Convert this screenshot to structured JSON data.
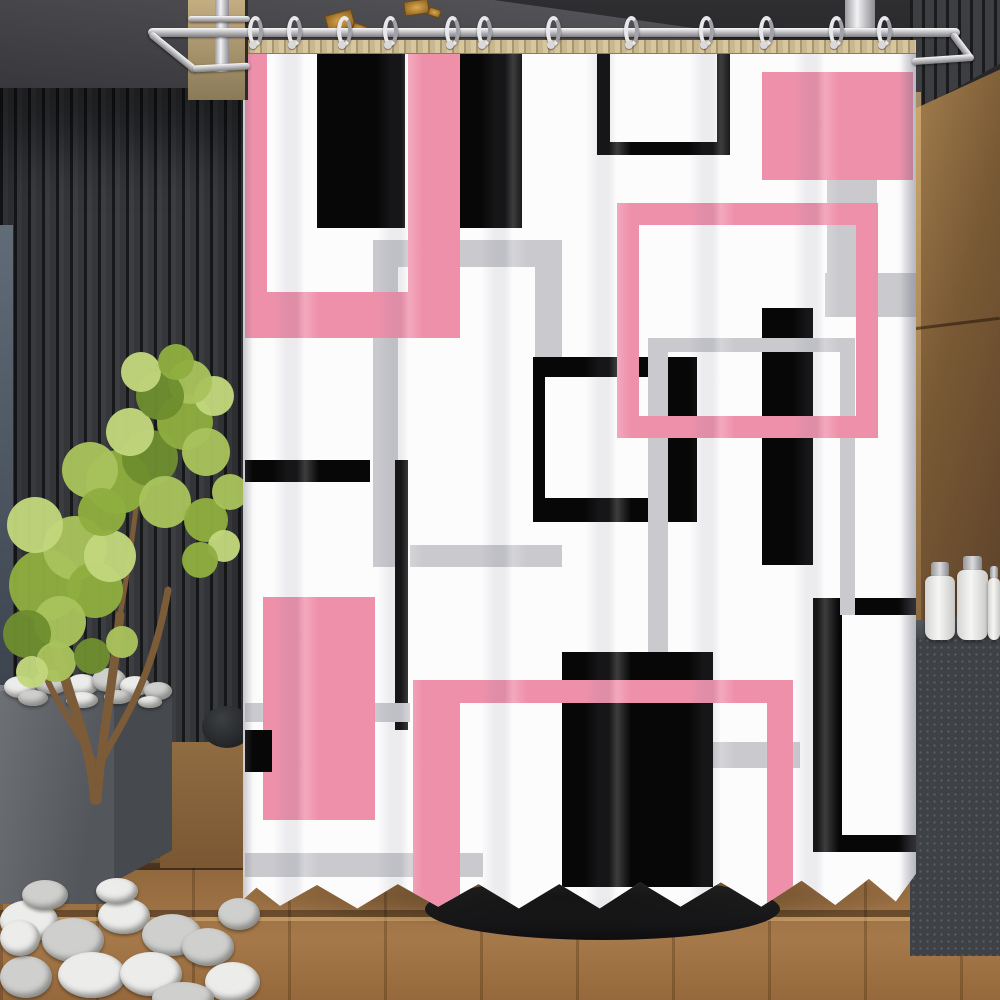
{
  "meta": {
    "description": "Product photo: white shower curtain with abstract pink, black and gray geometric rectangles, hanging from a chrome rod with C-rings in a modern bathroom with dark slatted walls, green potted tree, white pebbles, wooden plank floor, bronze wood wall and dark vanity with white bottles"
  },
  "palette": {
    "pink": "#EF90AB",
    "black": "#070707",
    "gray": "#C9C9CE",
    "curtain_white": "#FCFCFD",
    "pebble_light": "#ECECEA",
    "pebble_dark": "#CFCFCD",
    "greens": [
      "#8FAE3F",
      "#A9C35C",
      "#C2D67C",
      "#6E8E2F"
    ],
    "trunk": "#7B5B38",
    "gold": "#C9913B",
    "chrome": "#F0F0F2",
    "wood_floor": "#9A7142",
    "wood_wall": "#7A5A35",
    "tub": "#18181A"
  },
  "curtain": {
    "x": 243,
    "y": 40,
    "w": 673,
    "h": 872,
    "pattern": [
      {
        "name": "gray-open-frame-top",
        "color": "gray",
        "x": 130,
        "y": 200,
        "w": 189,
        "h": 27
      },
      {
        "name": "gray-open-frame-left-leg",
        "color": "gray",
        "x": 130,
        "y": 200,
        "w": 25,
        "h": 327
      },
      {
        "name": "gray-open-frame-right-leg",
        "color": "gray",
        "x": 292,
        "y": 200,
        "w": 27,
        "h": 125
      },
      {
        "name": "pink-u-left-arm",
        "color": "pink",
        "x": 2,
        "y": 10,
        "w": 22,
        "h": 288
      },
      {
        "name": "pink-u-bottom-bar",
        "color": "pink",
        "x": 2,
        "y": 252,
        "w": 215,
        "h": 46
      },
      {
        "name": "pink-u-right-arm",
        "color": "pink",
        "x": 165,
        "y": 10,
        "w": 52,
        "h": 252
      },
      {
        "name": "black-rect-top-1",
        "color": "black",
        "x": 74,
        "y": 10,
        "w": 88,
        "h": 178
      },
      {
        "name": "black-rect-top-2",
        "color": "black",
        "x": 217,
        "y": 10,
        "w": 62,
        "h": 178
      },
      {
        "name": "black-open-frame-left-edge",
        "color": "black",
        "x": 354,
        "y": 10,
        "w": 13,
        "h": 105
      },
      {
        "name": "black-open-frame-right-edge",
        "color": "black",
        "x": 474,
        "y": 10,
        "w": 13,
        "h": 105
      },
      {
        "name": "black-open-frame-bottom-edge",
        "color": "black",
        "x": 354,
        "y": 102,
        "w": 133,
        "h": 13
      },
      {
        "name": "pink-solid-rect-top-right",
        "color": "pink",
        "x": 519,
        "y": 32,
        "w": 151,
        "h": 108
      },
      {
        "name": "gray-bar-vertical-right",
        "color": "gray",
        "x": 584,
        "y": 140,
        "w": 50,
        "h": 100
      },
      {
        "name": "gray-bar-horizontal-right",
        "color": "gray",
        "x": 582,
        "y": 233,
        "w": 91,
        "h": 44
      },
      {
        "name": "black-frame-mid-left-edge",
        "color": "black",
        "x": 290,
        "y": 317,
        "w": 12,
        "h": 165
      },
      {
        "name": "black-frame-mid-top-edge",
        "color": "black",
        "x": 290,
        "y": 317,
        "w": 164,
        "h": 20
      },
      {
        "name": "black-frame-mid-bottom-edge",
        "color": "black",
        "x": 290,
        "y": 458,
        "w": 164,
        "h": 24
      },
      {
        "name": "black-frame-mid-right-bar",
        "color": "black",
        "x": 420,
        "y": 317,
        "w": 34,
        "h": 165
      },
      {
        "name": "black-bar-tall-right",
        "color": "black",
        "x": 519,
        "y": 268,
        "w": 51,
        "h": 257
      },
      {
        "name": "black-rect-large-bottom",
        "color": "black",
        "x": 319,
        "y": 612,
        "w": 151,
        "h": 235
      },
      {
        "name": "black-frame-br-top-edge",
        "color": "black",
        "x": 570,
        "y": 558,
        "w": 103,
        "h": 17
      },
      {
        "name": "black-frame-br-left-edge",
        "color": "black",
        "x": 570,
        "y": 558,
        "w": 29,
        "h": 254
      },
      {
        "name": "black-frame-br-bottom-edge",
        "color": "black",
        "x": 570,
        "y": 795,
        "w": 103,
        "h": 17
      },
      {
        "name": "gray-frame-2-top-edge",
        "color": "gray",
        "x": 405,
        "y": 298,
        "w": 205,
        "h": 14
      },
      {
        "name": "gray-frame-2-left-leg",
        "color": "gray",
        "x": 405,
        "y": 298,
        "w": 20,
        "h": 314
      },
      {
        "name": "gray-frame-2-right-leg",
        "color": "gray",
        "x": 597,
        "y": 298,
        "w": 15,
        "h": 277
      },
      {
        "name": "pink-frame-top-edge",
        "color": "pink",
        "x": 374,
        "y": 163,
        "w": 261,
        "h": 22
      },
      {
        "name": "pink-frame-left-edge",
        "color": "pink",
        "x": 374,
        "y": 163,
        "w": 22,
        "h": 235
      },
      {
        "name": "pink-frame-right-edge",
        "color": "pink",
        "x": 613,
        "y": 163,
        "w": 22,
        "h": 235
      },
      {
        "name": "pink-frame-bottom-edge",
        "color": "pink",
        "x": 374,
        "y": 376,
        "w": 261,
        "h": 22
      },
      {
        "name": "gray-band-mid",
        "color": "gray",
        "x": 167,
        "y": 505,
        "w": 152,
        "h": 22
      },
      {
        "name": "black-thin-vertical",
        "color": "black",
        "x": 152,
        "y": 420,
        "w": 13,
        "h": 270
      },
      {
        "name": "black-bar-left",
        "color": "black",
        "x": 2,
        "y": 420,
        "w": 125,
        "h": 22
      },
      {
        "name": "gray-band-left-1",
        "color": "gray",
        "x": 2,
        "y": 663,
        "w": 165,
        "h": 19
      },
      {
        "name": "pink-solid-rect-left",
        "color": "pink",
        "x": 20,
        "y": 557,
        "w": 112,
        "h": 223
      },
      {
        "name": "black-small-rect-left",
        "color": "black",
        "x": 2,
        "y": 690,
        "w": 27,
        "h": 42
      },
      {
        "name": "gray-band-left-2",
        "color": "gray",
        "x": 2,
        "y": 813,
        "w": 238,
        "h": 24
      },
      {
        "name": "gray-band-right-low",
        "color": "gray",
        "x": 470,
        "y": 702,
        "w": 87,
        "h": 26
      },
      {
        "name": "pink-staple-top-bar",
        "color": "pink",
        "x": 170,
        "y": 640,
        "w": 380,
        "h": 23
      },
      {
        "name": "pink-staple-left-leg",
        "color": "pink",
        "x": 170,
        "y": 640,
        "w": 47,
        "h": 232
      },
      {
        "name": "pink-staple-right-leg",
        "color": "pink",
        "x": 524,
        "y": 640,
        "w": 26,
        "h": 232
      }
    ]
  },
  "rod": {
    "x": 148,
    "y": 28,
    "w": 812,
    "h": 9
  },
  "hooks": {
    "count": 12,
    "y": 16,
    "centers": [
      256,
      295,
      345,
      391,
      453,
      485,
      554,
      632,
      707,
      767,
      837,
      885
    ]
  },
  "ceiling_lights": [
    {
      "x": 326,
      "y": 12,
      "w": 28,
      "h": 18,
      "r": -15
    },
    {
      "x": 352,
      "y": 24,
      "w": 15,
      "h": 10,
      "r": 20
    },
    {
      "x": 404,
      "y": 0,
      "w": 25,
      "h": 15,
      "r": -8
    },
    {
      "x": 428,
      "y": 8,
      "w": 13,
      "h": 9,
      "r": 18
    }
  ],
  "bottles": [
    {
      "x": 925,
      "y": 576,
      "w": 30,
      "h": 64,
      "cap_w": 18,
      "cap_h": 16
    },
    {
      "x": 957,
      "y": 570,
      "w": 31,
      "h": 70,
      "cap_w": 19,
      "cap_h": 16
    },
    {
      "x": 988,
      "y": 578,
      "w": 12,
      "h": 62,
      "cap_w": 8,
      "cap_h": 14
    }
  ],
  "steps": [
    {
      "name": "step-edge-highlight-1",
      "cls": "step-hi",
      "x": 110,
      "y": 858,
      "w": 890,
      "h": 5
    },
    {
      "name": "step-edge-shadow",
      "cls": "step-sh",
      "x": 0,
      "y": 910,
      "w": 1000,
      "h": 7
    },
    {
      "name": "step-edge-highlight-2",
      "cls": "step-hi",
      "x": 0,
      "y": 917,
      "w": 1000,
      "h": 4
    }
  ],
  "plant": {
    "foliage": [
      [
        45,
        585,
        36,
        0
      ],
      [
        75,
        548,
        32,
        1
      ],
      [
        35,
        525,
        28,
        2
      ],
      [
        95,
        590,
        28,
        0
      ],
      [
        60,
        622,
        26,
        1
      ],
      [
        27,
        634,
        24,
        3
      ],
      [
        110,
        556,
        26,
        2
      ],
      [
        118,
        482,
        32,
        0
      ],
      [
        90,
        470,
        28,
        1
      ],
      [
        150,
        458,
        28,
        3
      ],
      [
        130,
        432,
        24,
        2
      ],
      [
        165,
        502,
        26,
        1
      ],
      [
        102,
        512,
        24,
        0
      ],
      [
        185,
        422,
        28,
        0
      ],
      [
        206,
        452,
        24,
        1
      ],
      [
        214,
        396,
        20,
        2
      ],
      [
        190,
        382,
        22,
        1
      ],
      [
        160,
        396,
        24,
        3
      ],
      [
        141,
        372,
        20,
        2
      ],
      [
        176,
        362,
        18,
        0
      ],
      [
        206,
        520,
        22,
        0
      ],
      [
        230,
        492,
        18,
        1
      ],
      [
        224,
        546,
        16,
        2
      ],
      [
        56,
        662,
        20,
        1
      ],
      [
        92,
        656,
        18,
        3
      ],
      [
        32,
        672,
        16,
        2
      ],
      [
        122,
        642,
        16,
        1
      ],
      [
        200,
        560,
        18,
        0
      ]
    ],
    "trunks": [
      {
        "d": "M100,490 C97,435 75,395 61,335",
        "w": 10
      },
      {
        "d": "M102,490 C107,425 117,380 125,305",
        "w": 9
      },
      {
        "d": "M104,455 C127,412 157,372 173,280",
        "w": 7
      },
      {
        "d": "M98,450 C77,412 53,382 45,348",
        "w": 6
      },
      {
        "d": "M125,305 C133,262 137,230 141,198",
        "w": 5
      }
    ]
  },
  "pebbles": {
    "pot": [
      [
        4,
        676,
        32,
        22,
        0
      ],
      [
        34,
        670,
        36,
        24,
        1
      ],
      [
        66,
        674,
        32,
        22,
        0
      ],
      [
        92,
        668,
        34,
        24,
        1
      ],
      [
        120,
        676,
        30,
        20,
        0
      ],
      [
        144,
        682,
        28,
        18,
        1
      ],
      [
        18,
        690,
        30,
        16,
        1
      ],
      [
        66,
        692,
        32,
        16,
        0
      ],
      [
        104,
        690,
        28,
        14,
        1
      ],
      [
        138,
        696,
        24,
        12,
        0
      ]
    ],
    "ground": [
      [
        0,
        900,
        58,
        42,
        0
      ],
      [
        42,
        918,
        62,
        44,
        1
      ],
      [
        98,
        898,
        52,
        36,
        0
      ],
      [
        142,
        914,
        60,
        42,
        1
      ],
      [
        58,
        952,
        68,
        46,
        0
      ],
      [
        0,
        956,
        52,
        42,
        1
      ],
      [
        120,
        952,
        62,
        44,
        0
      ],
      [
        182,
        928,
        52,
        38,
        1
      ],
      [
        205,
        962,
        55,
        40,
        0
      ],
      [
        152,
        982,
        62,
        32,
        1
      ],
      [
        22,
        880,
        46,
        30,
        1
      ],
      [
        96,
        878,
        42,
        26,
        0
      ],
      [
        218,
        898,
        42,
        32,
        1
      ],
      [
        0,
        920,
        40,
        36,
        0
      ]
    ]
  }
}
